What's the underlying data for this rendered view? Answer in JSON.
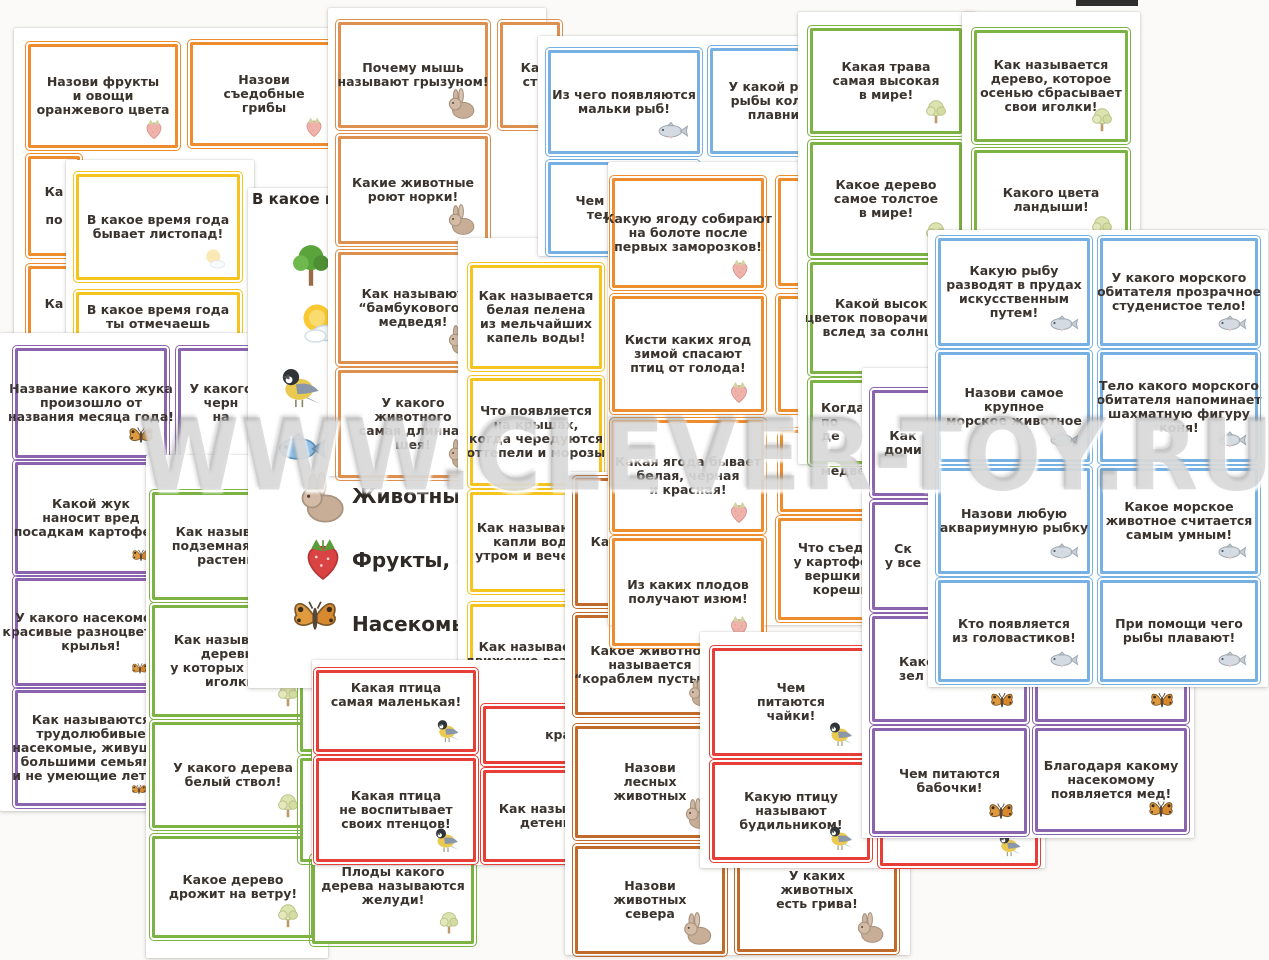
{
  "watermark": "WWW.CLEVER-TOY.RU",
  "colors": {
    "orange": "#ee8d2d",
    "tan": "#dd9050",
    "brown": "#c06a2c",
    "yellow": "#f6c41f",
    "green": "#7cb342",
    "blue": "#77b0e2",
    "purple": "#8a64ad",
    "red": "#e73f37"
  },
  "artifact": {
    "x": 1076,
    "y": 0,
    "w": 62,
    "h": 6,
    "color": "#2e2e2e"
  },
  "texts": [
    {
      "x": 252,
      "y": 190,
      "size": 15,
      "z": 51,
      "text": "В какое вре"
    }
  ],
  "legend": {
    "items": [
      {
        "icon": "tree",
        "x": 286,
        "y": 242,
        "s": 50,
        "label": "",
        "lx": 0,
        "ly": 0
      },
      {
        "icon": "sun",
        "x": 296,
        "y": 300,
        "s": 48,
        "label": "",
        "lx": 0,
        "ly": 0
      },
      {
        "icon": "bird",
        "x": 278,
        "y": 360,
        "s": 52,
        "label": "",
        "lx": 0,
        "ly": 0
      },
      {
        "icon": "fish",
        "x": 274,
        "y": 420,
        "s": 54,
        "label": "",
        "lx": 0,
        "ly": 0
      },
      {
        "icon": "rabbit",
        "x": 292,
        "y": 470,
        "s": 56,
        "label": "Животные",
        "lx": 352,
        "ly": 484
      },
      {
        "icon": "strawberry",
        "x": 296,
        "y": 530,
        "s": 54,
        "label": "Фрукты, овощи",
        "lx": 352,
        "ly": 548
      },
      {
        "icon": "butterfly",
        "x": 288,
        "y": 590,
        "s": 54,
        "label": "Насекомые",
        "lx": 352,
        "ly": 612
      }
    ]
  },
  "sheets": [
    {
      "x": 14,
      "y": 28,
      "w": 326,
      "h": 318,
      "z": 10
    },
    {
      "x": 66,
      "y": 160,
      "w": 188,
      "h": 195,
      "z": 20
    },
    {
      "x": 0,
      "y": 333,
      "w": 270,
      "h": 478,
      "z": 30
    },
    {
      "x": 146,
      "y": 455,
      "w": 182,
      "h": 503,
      "z": 40
    },
    {
      "x": 248,
      "y": 188,
      "w": 212,
      "h": 500,
      "z": 50
    },
    {
      "x": 328,
      "y": 8,
      "w": 218,
      "h": 468,
      "z": 60
    },
    {
      "x": 458,
      "y": 238,
      "w": 176,
      "h": 468,
      "z": 70
    },
    {
      "x": 538,
      "y": 36,
      "w": 270,
      "h": 220,
      "z": 80
    },
    {
      "x": 312,
      "y": 660,
      "w": 258,
      "h": 205,
      "z": 85
    },
    {
      "x": 565,
      "y": 472,
      "w": 345,
      "h": 483,
      "z": 90
    },
    {
      "x": 608,
      "y": 162,
      "w": 310,
      "h": 463,
      "z": 100
    },
    {
      "x": 798,
      "y": 12,
      "w": 178,
      "h": 452,
      "z": 110
    },
    {
      "x": 962,
      "y": 12,
      "w": 178,
      "h": 240,
      "z": 112
    },
    {
      "x": 700,
      "y": 632,
      "w": 345,
      "h": 236,
      "z": 130
    },
    {
      "x": 862,
      "y": 368,
      "w": 332,
      "h": 470,
      "z": 140
    },
    {
      "x": 928,
      "y": 230,
      "w": 340,
      "h": 457,
      "z": 150
    }
  ],
  "cards": [
    {
      "sheet": 0,
      "x": 28,
      "y": 44,
      "w": 150,
      "h": 104,
      "color": "orange",
      "icon": "strawberry-pale",
      "icon_size": 26,
      "lines": [
        "Назови фрукты",
        "и овощи",
        "оранжевого цвета"
      ]
    },
    {
      "sheet": 0,
      "x": 190,
      "y": 42,
      "w": 148,
      "h": 104,
      "color": "orange",
      "icon": "strawberry-pale",
      "icon_size": 26,
      "lines": [
        "Назови",
        "съедобные",
        "грибы"
      ]
    },
    {
      "sheet": 0,
      "x": 28,
      "y": 156,
      "w": 52,
      "h": 100,
      "color": "orange",
      "lines": [
        "Ка",
        " ",
        "по"
      ]
    },
    {
      "sheet": 0,
      "x": 28,
      "y": 266,
      "w": 52,
      "h": 76,
      "color": "orange",
      "lines": [
        "Ка"
      ]
    },
    {
      "sheet": 1,
      "x": 76,
      "y": 174,
      "w": 164,
      "h": 106,
      "color": "yellow",
      "icon": "sun-pale",
      "icon_size": 28,
      "lines": [
        "В какое время года",
        "бывает листопад!"
      ]
    },
    {
      "sheet": 1,
      "x": 76,
      "y": 292,
      "w": 164,
      "h": 90,
      "color": "yellow",
      "pt": 8,
      "lines": [
        "В какое время года",
        "ты отмечаешь"
      ]
    },
    {
      "sheet": 2,
      "x": 15,
      "y": 348,
      "w": 152,
      "h": 110,
      "color": "purple",
      "icon": "butterfly",
      "icon_size": 30,
      "lines": [
        "Название какого жука",
        "произошло от",
        "названия месяца года!"
      ]
    },
    {
      "sheet": 2,
      "x": 178,
      "y": 348,
      "w": 86,
      "h": 110,
      "color": "purple",
      "lines": [
        "У какого",
        "черн",
        "на"
      ]
    },
    {
      "sheet": 2,
      "x": 15,
      "y": 462,
      "w": 152,
      "h": 112,
      "color": "purple",
      "icon": "butterfly",
      "icon_size": 22,
      "icon_left": 112,
      "lines": [
        "Какой жук",
        "наносит вред",
        "посадкам картофеля"
      ]
    },
    {
      "sheet": 2,
      "x": 15,
      "y": 578,
      "w": 152,
      "h": 108,
      "color": "purple",
      "icon": "butterfly",
      "icon_size": 20,
      "icon_left": 112,
      "lines": [
        "У какого насекомого",
        "красивые разноцветные",
        "крылья!"
      ]
    },
    {
      "sheet": 2,
      "x": 15,
      "y": 690,
      "w": 152,
      "h": 116,
      "color": "purple",
      "icon": "butterfly",
      "icon_size": 18,
      "icon_left": 112,
      "lines": [
        "Как называются",
        "трудолюбивые",
        "насекомые, живущие",
        "большими семьями",
        "и не умеющие летать"
      ]
    },
    {
      "sheet": 3,
      "x": 152,
      "y": 492,
      "w": 162,
      "h": 108,
      "color": "green",
      "lines": [
        "Как называется",
        "подземная часть",
        "растения!"
      ]
    },
    {
      "sheet": 3,
      "x": 152,
      "y": 605,
      "w": 162,
      "h": 112,
      "color": "green",
      "icon": "tree-pale",
      "icon_size": 30,
      "lines": [
        "Как называются",
        "деревья,",
        "у которых растут",
        "иголки!"
      ]
    },
    {
      "sheet": 3,
      "x": 152,
      "y": 722,
      "w": 162,
      "h": 106,
      "color": "green",
      "icon": "tree-pale",
      "icon_size": 30,
      "lines": [
        "У какого дерева",
        "белый ствол!"
      ]
    },
    {
      "sheet": 3,
      "x": 152,
      "y": 836,
      "w": 162,
      "h": 102,
      "color": "green",
      "icon": "tree-pale",
      "icon_size": 30,
      "lines": [
        "Какое дерево",
        "дрожит на ветру!"
      ]
    },
    {
      "sheet": 3,
      "x": 300,
      "y": 672,
      "w": 170,
      "h": 80,
      "color": "green",
      "lines": []
    },
    {
      "sheet": 3,
      "x": 300,
      "y": 758,
      "w": 170,
      "h": 104,
      "color": "green",
      "lines": []
    },
    {
      "sheet": 3,
      "x": 312,
      "y": 856,
      "w": 162,
      "h": 88,
      "color": "green",
      "icon": "tree-pale",
      "icon_size": 28,
      "pt": 6,
      "lines": [
        "Плоды какого",
        "дерева называются",
        "желуди!"
      ]
    },
    {
      "sheet": 5,
      "x": 338,
      "y": 22,
      "w": 150,
      "h": 106,
      "color": "tan",
      "icon": "rabbit",
      "icon_size": 34,
      "lines": [
        "Почему мышь",
        "называют грызуном!"
      ]
    },
    {
      "sheet": 5,
      "x": 338,
      "y": 136,
      "w": 150,
      "h": 108,
      "color": "tan",
      "icon": "rabbit",
      "icon_size": 34,
      "lines": [
        "Какие животные",
        "роют норки!"
      ]
    },
    {
      "sheet": 5,
      "x": 338,
      "y": 252,
      "w": 150,
      "h": 112,
      "color": "tan",
      "icon": "rabbit",
      "icon_size": 34,
      "lines": [
        "Как называют",
        "“бамбукового”",
        "медведя!"
      ]
    },
    {
      "sheet": 5,
      "x": 338,
      "y": 370,
      "w": 150,
      "h": 108,
      "color": "tan",
      "icon": "rabbit",
      "icon_size": 34,
      "lines": [
        "У какого",
        "животного",
        "самая длинная",
        "шея!"
      ]
    },
    {
      "sheet": 5,
      "x": 500,
      "y": 22,
      "w": 60,
      "h": 106,
      "color": "tan",
      "lines": [
        "Ка",
        "ст"
      ]
    },
    {
      "sheet": 6,
      "x": 470,
      "y": 265,
      "w": 132,
      "h": 104,
      "color": "yellow",
      "lines": [
        "Как называется",
        "белая пелена",
        "из мельчайших",
        "капель воды!"
      ]
    },
    {
      "sheet": 6,
      "x": 470,
      "y": 378,
      "w": 132,
      "h": 108,
      "color": "yellow",
      "lines": [
        "Что появляется",
        "на крышах,",
        "когда чередуются",
        "оттепели и морозы"
      ]
    },
    {
      "sheet": 6,
      "x": 470,
      "y": 492,
      "w": 132,
      "h": 100,
      "color": "yellow",
      "lines": [
        "Как называются",
        "капли воды",
        "утром и вечером"
      ]
    },
    {
      "sheet": 6,
      "x": 470,
      "y": 604,
      "w": 132,
      "h": 100,
      "color": "yellow",
      "lines": [
        "Как называется",
        "движение воздуха!"
      ]
    },
    {
      "sheet": 7,
      "x": 548,
      "y": 50,
      "w": 152,
      "h": 104,
      "color": "blue",
      "icon": "fish-pale",
      "icon_size": 34,
      "lines": [
        "Из чего появляются",
        "мальки рыб!"
      ]
    },
    {
      "sheet": 7,
      "x": 710,
      "y": 48,
      "w": 150,
      "h": 106,
      "color": "blue",
      "lines": [
        "У какой речной",
        "рыбы колючие",
        "плавники!"
      ]
    },
    {
      "sheet": 7,
      "x": 548,
      "y": 162,
      "w": 150,
      "h": 92,
      "color": "blue",
      "lines": [
        "Чем покрыто",
        "тело рыб!"
      ]
    },
    {
      "sheet": 8,
      "x": 316,
      "y": 670,
      "w": 160,
      "h": 82,
      "color": "red",
      "icon": "bird",
      "icon_size": 30,
      "pt": 8,
      "lines": [
        "Какая птица",
        "самая маленькая!"
      ]
    },
    {
      "sheet": 8,
      "x": 316,
      "y": 758,
      "w": 160,
      "h": 104,
      "color": "red",
      "icon": "bird",
      "icon_size": 32,
      "lines": [
        "Какая птица",
        "не воспитывает",
        "своих птенцов!"
      ]
    },
    {
      "sheet": 8,
      "x": 483,
      "y": 706,
      "w": 150,
      "h": 58,
      "color": "red",
      "lines": [
        "кра"
      ]
    },
    {
      "sheet": 8,
      "x": 483,
      "y": 770,
      "w": 150,
      "h": 92,
      "color": "red",
      "lines": [
        "Как называются",
        "детеныши"
      ]
    },
    {
      "sheet": 9,
      "x": 575,
      "y": 478,
      "w": 50,
      "h": 128,
      "color": "brown",
      "lines": [
        "Ка"
      ]
    },
    {
      "sheet": 9,
      "x": 575,
      "y": 615,
      "w": 150,
      "h": 100,
      "color": "brown",
      "icon": "rabbit",
      "icon_size": 30,
      "lines": [
        "Какое животное",
        "называется",
        "“кораблем пустыни”"
      ]
    },
    {
      "sheet": 9,
      "x": 575,
      "y": 726,
      "w": 150,
      "h": 112,
      "color": "brown",
      "icon": "rabbit",
      "icon_size": 34,
      "lines": [
        "Назови",
        "лесных",
        "животных"
      ]
    },
    {
      "sheet": 9,
      "x": 575,
      "y": 846,
      "w": 150,
      "h": 108,
      "color": "brown",
      "icon": "rabbit",
      "icon_size": 36,
      "lines": [
        "Назови",
        "животных",
        "севера"
      ]
    },
    {
      "sheet": 9,
      "x": 737,
      "y": 822,
      "w": 160,
      "h": 130,
      "color": "brown",
      "icon": "rabbit",
      "icon_size": 34,
      "pt": 44,
      "lines": [
        "У каких",
        "животных",
        "есть грива!"
      ]
    },
    {
      "sheet": 10,
      "x": 612,
      "y": 178,
      "w": 152,
      "h": 110,
      "color": "orange",
      "icon": "strawberry-pale",
      "icon_size": 26,
      "lines": [
        "Какую ягоду собирают",
        "на болоте после",
        "первых заморозков!"
      ]
    },
    {
      "sheet": 10,
      "x": 612,
      "y": 296,
      "w": 152,
      "h": 116,
      "color": "orange",
      "icon": "strawberry-pale",
      "icon_size": 28,
      "lines": [
        "Кисти каких ягод",
        "зимой спасают",
        "птиц от голода!"
      ]
    },
    {
      "sheet": 10,
      "x": 612,
      "y": 420,
      "w": 152,
      "h": 112,
      "color": "orange",
      "icon": "strawberry-pale",
      "icon_size": 28,
      "lines": [
        "Какая ягода бывает",
        "белая, черная",
        "и красная!"
      ]
    },
    {
      "sheet": 10,
      "x": 612,
      "y": 538,
      "w": 152,
      "h": 108,
      "color": "orange",
      "icon": "strawberry-pale",
      "icon_size": 28,
      "lines": [
        "Из каких плодов",
        "получают изюм!"
      ]
    },
    {
      "sheet": 10,
      "x": 778,
      "y": 178,
      "w": 140,
      "h": 108,
      "color": "orange",
      "lines": []
    },
    {
      "sheet": 10,
      "x": 778,
      "y": 296,
      "w": 140,
      "h": 116,
      "color": "orange",
      "lines": []
    },
    {
      "sheet": 10,
      "x": 780,
      "y": 430,
      "w": 150,
      "h": 82,
      "color": "orange",
      "lines": [
        "медведя!"
      ]
    },
    {
      "sheet": 10,
      "x": 778,
      "y": 518,
      "w": 140,
      "h": 102,
      "color": "orange",
      "lines": [
        "Что съедобно",
        "у картофеля —",
        "вершки или",
        "корешки!"
      ]
    },
    {
      "sheet": 11,
      "x": 810,
      "y": 28,
      "w": 152,
      "h": 106,
      "color": "green",
      "icon": "tree-pale",
      "icon_size": 30,
      "lines": [
        "Какая трава",
        "самая высокая",
        "в мире!"
      ]
    },
    {
      "sheet": 11,
      "x": 810,
      "y": 142,
      "w": 152,
      "h": 114,
      "color": "green",
      "icon": "tree-pale",
      "icon_size": 30,
      "lines": [
        "Какое дерево",
        "самое толстое",
        "в мире!"
      ]
    },
    {
      "sheet": 11,
      "x": 810,
      "y": 262,
      "w": 160,
      "h": 112,
      "color": "green",
      "lines": [
        "Какой высокий",
        "цветок поворачивается",
        "вслед за солнцем!"
      ]
    },
    {
      "sheet": 11,
      "x": 810,
      "y": 380,
      "w": 114,
      "h": 84,
      "color": "green",
      "align": "left",
      "lines": [
        "Когда р",
        "по",
        "де"
      ]
    },
    {
      "sheet": 12,
      "x": 974,
      "y": 30,
      "w": 154,
      "h": 112,
      "color": "green",
      "icon": "tree-pale",
      "icon_size": 30,
      "lines": [
        "Как называется",
        "дерево, которое",
        "осенью сбрасывает",
        "свои иголки!"
      ]
    },
    {
      "sheet": 12,
      "x": 974,
      "y": 150,
      "w": 154,
      "h": 100,
      "color": "green",
      "icon": "tree-pale",
      "icon_size": 30,
      "lines": [
        "Какого цвета",
        "ландыши!"
      ]
    },
    {
      "sheet": 13,
      "x": 712,
      "y": 648,
      "w": 158,
      "h": 108,
      "color": "red",
      "icon": "bird",
      "icon_size": 32,
      "lines": [
        "Чем",
        "питаются",
        "чайки!"
      ]
    },
    {
      "sheet": 13,
      "x": 712,
      "y": 762,
      "w": 158,
      "h": 98,
      "color": "red",
      "icon": "bird",
      "icon_size": 32,
      "lines": [
        "Какую птицу",
        "называют",
        "будильником!"
      ]
    },
    {
      "sheet": 13,
      "x": 880,
      "y": 700,
      "w": 158,
      "h": 166,
      "color": "red",
      "icon": "bird",
      "icon_size": 30,
      "lines": []
    },
    {
      "sheet": 14,
      "x": 872,
      "y": 390,
      "w": 62,
      "h": 106,
      "color": "purple",
      "lines": [
        "Как",
        "доми"
      ]
    },
    {
      "sheet": 14,
      "x": 872,
      "y": 502,
      "w": 62,
      "h": 108,
      "color": "purple",
      "lines": [
        "Ск",
        "у все"
      ]
    },
    {
      "sheet": 14,
      "x": 872,
      "y": 616,
      "w": 155,
      "h": 106,
      "color": "purple",
      "icon": "butterfly",
      "icon_size": 28,
      "align": "left",
      "pl": 24,
      "lines": [
        "Како",
        "зел"
      ]
    },
    {
      "sheet": 14,
      "x": 1035,
      "y": 616,
      "w": 152,
      "h": 106,
      "color": "purple",
      "icon": "butterfly",
      "icon_size": 28,
      "lines": []
    },
    {
      "sheet": 14,
      "x": 872,
      "y": 728,
      "w": 155,
      "h": 106,
      "color": "purple",
      "icon": "butterfly",
      "icon_size": 30,
      "lines": [
        "Чем питаются",
        "бабочки!"
      ]
    },
    {
      "sheet": 14,
      "x": 1035,
      "y": 728,
      "w": 152,
      "h": 104,
      "color": "purple",
      "icon": "butterfly",
      "icon_size": 30,
      "lines": [
        "Благодаря какому",
        "насекомому",
        "появляется мед!"
      ]
    },
    {
      "sheet": 15,
      "x": 938,
      "y": 238,
      "w": 152,
      "h": 108,
      "color": "blue",
      "icon": "fish-pale",
      "icon_size": 32,
      "lines": [
        "Какую рыбу",
        "разводят в прудах",
        "искусственным",
        "путем!"
      ]
    },
    {
      "sheet": 15,
      "x": 1100,
      "y": 238,
      "w": 158,
      "h": 108,
      "color": "blue",
      "icon": "fish-pale",
      "icon_size": 32,
      "lines": [
        "У какого морского",
        "обитателя прозрачное",
        "студенистое тело!"
      ]
    },
    {
      "sheet": 15,
      "x": 938,
      "y": 352,
      "w": 152,
      "h": 110,
      "color": "blue",
      "icon": "fish-pale",
      "icon_size": 32,
      "lines": [
        "Назови самое",
        "крупное",
        "морское животное"
      ]
    },
    {
      "sheet": 15,
      "x": 1100,
      "y": 352,
      "w": 158,
      "h": 110,
      "color": "blue",
      "icon": "fish-pale",
      "icon_size": 32,
      "lines": [
        "Тело какого морского",
        "обитателя напоминает",
        "шахматную фигуру",
        "коня!"
      ]
    },
    {
      "sheet": 15,
      "x": 938,
      "y": 468,
      "w": 152,
      "h": 106,
      "color": "blue",
      "icon": "fish-pale",
      "icon_size": 32,
      "lines": [
        "Назови любую",
        "аквариумную рыбку"
      ]
    },
    {
      "sheet": 15,
      "x": 1100,
      "y": 468,
      "w": 158,
      "h": 106,
      "color": "blue",
      "icon": "fish-pale",
      "icon_size": 32,
      "lines": [
        "Какое морское",
        "животное считается",
        "самым умным!"
      ]
    },
    {
      "sheet": 15,
      "x": 938,
      "y": 580,
      "w": 152,
      "h": 102,
      "color": "blue",
      "icon": "fish-pale",
      "icon_size": 32,
      "lines": [
        "Кто появляется",
        "из головастиков!"
      ]
    },
    {
      "sheet": 15,
      "x": 1100,
      "y": 580,
      "w": 158,
      "h": 102,
      "color": "blue",
      "icon": "fish-pale",
      "icon_size": 32,
      "lines": [
        "При помощи чего",
        "рыбы плавают!"
      ]
    }
  ]
}
